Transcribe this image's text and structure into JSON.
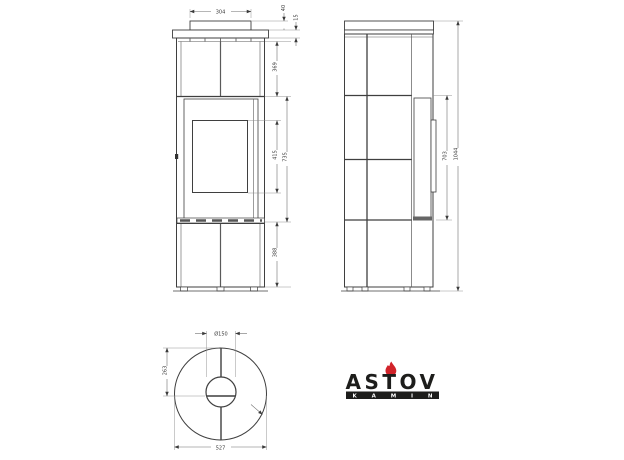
{
  "drawing": {
    "title": "stove-technical-drawing",
    "front_view": {
      "dims": {
        "top_width": "304",
        "slab_height": "40",
        "plate_thickness": "15",
        "upper_section": "369",
        "window_height": "415",
        "door_section": "735",
        "lower_section": "388"
      }
    },
    "side_view": {
      "dims": {
        "door_height": "703",
        "total_height": "1044"
      }
    },
    "top_view": {
      "dims": {
        "flue_diameter": "Ø150",
        "flue_offset": "263",
        "outer_diameter": "527"
      }
    },
    "logo": {
      "brand": "ASTOV",
      "sub": "KAMIN",
      "flame_color": "#d1232a",
      "text_color": "#1d1d1b"
    },
    "colors": {
      "line": "#3f3f3f",
      "dimension_line": "#6e6e6e",
      "background": "#ffffff"
    }
  }
}
